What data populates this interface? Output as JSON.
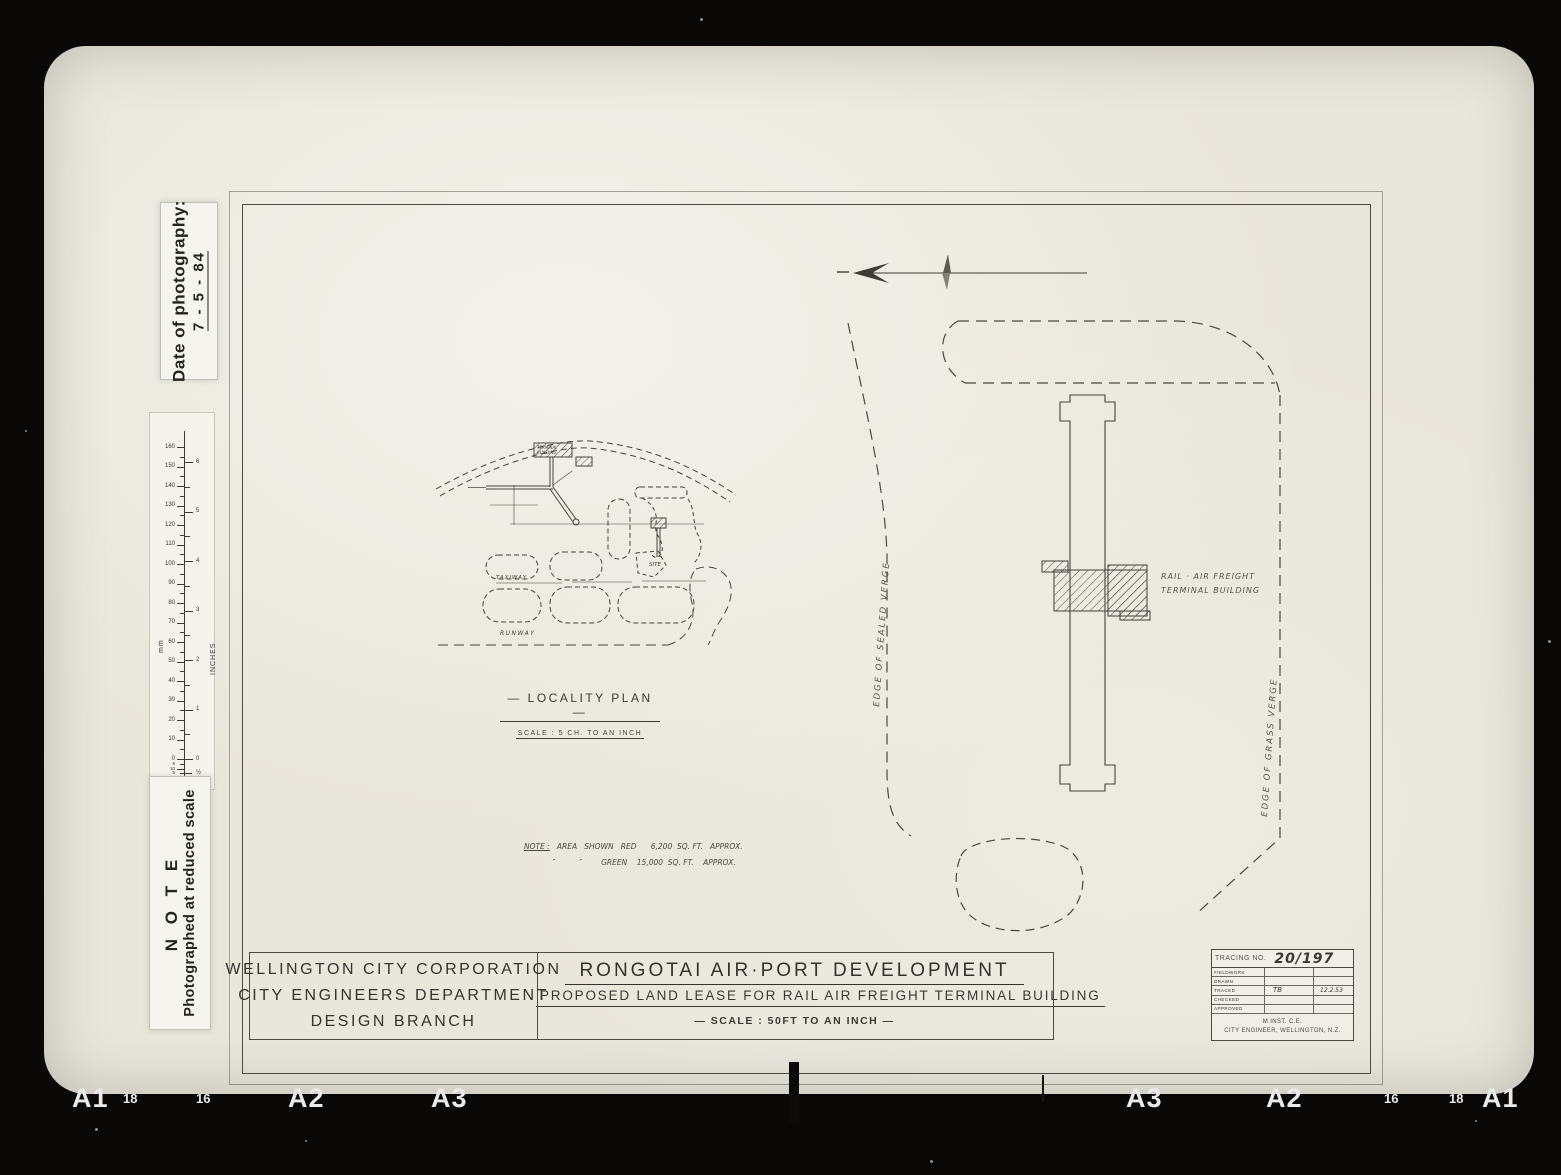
{
  "photo": {
    "date_stamp": {
      "label": "Date of photography:",
      "value": "7 - 5 - 84"
    },
    "note_stamp": {
      "title": "N O T E",
      "text": "Photographed at reduced scale"
    },
    "ruler": {
      "mm_unit": "mm",
      "inch_unit": "INCHES",
      "mm_labels": [
        "0",
        "10",
        "20",
        "30",
        "40",
        "50",
        "60",
        "70",
        "80",
        "90",
        "100",
        "110",
        "120",
        "130",
        "140",
        "150",
        "160"
      ],
      "inch_labels": [
        "0",
        "1",
        "2",
        "3",
        "4",
        "5",
        "6"
      ],
      "below_zero_mm": [
        "5",
        "10",
        "5",
        "20",
        "5",
        "30"
      ],
      "below_zero_inch": [
        "½",
        "1"
      ]
    },
    "film_labels_left": [
      "A1",
      "18",
      "16",
      "A2",
      "A3"
    ],
    "film_labels_right": [
      "A3",
      "A2",
      "16",
      "18",
      "A1"
    ]
  },
  "sheet": {
    "locality": {
      "title": "— LOCALITY  PLAN —",
      "scale": "SCALE  :  5 CH. TO  AN  INCH",
      "terminal_label_1": "TERMINAL",
      "terminal_label_2": "BUILDING",
      "taxiway_label": "TAXIWAY",
      "runway_label": "RUNWAY",
      "site_label": "SITE"
    },
    "area_note": {
      "heading": "NOTE :",
      "line1": "   AREA   SHOWN   RED      6,200  SQ. FT.   APPROX.",
      "line2": "            ″          ″        GREEN    15,000  SQ. FT.    APPROX."
    },
    "main_plan": {
      "building_label_1": "RAIL · AIR  FREIGHT",
      "building_label_2": "TERMINAL  BUILDING",
      "edge_sealed": "EDGE   OF   SEALED   VERGE",
      "edge_grass": "EDGE   OF   GRASS   VERGE"
    },
    "title_block": {
      "org": [
        "WELLINGTON  CITY  CORPORATION",
        "CITY  ENGINEERS  DEPARTMENT",
        "DESIGN   BRANCH"
      ],
      "title": "RONGOTAI   AIR·PORT   DEVELOPMENT",
      "subtitle": "PROPOSED  LAND  LEASE  FOR  RAIL AIR FREIGHT   TERMINAL  BUILDING",
      "scale": "—   SCALE :  50FT  TO  AN  INCH   —",
      "tracing": {
        "label": "TRACING NO.",
        "number": "20/197",
        "rows": [
          {
            "label": "FIELDWORK",
            "sig": "",
            "date": ""
          },
          {
            "label": "DRAWN",
            "sig": "",
            "date": ""
          },
          {
            "label": "TRACED",
            "sig": "TB",
            "date": "12.2.53"
          },
          {
            "label": "CHECKED",
            "sig": "",
            "date": ""
          },
          {
            "label": "APPROVED",
            "sig": "",
            "date": ""
          }
        ],
        "engineer_line1": "M.INST. C.E.",
        "engineer_line2": "CITY ENGINEER, WELLINGTON, N.Z."
      }
    }
  }
}
